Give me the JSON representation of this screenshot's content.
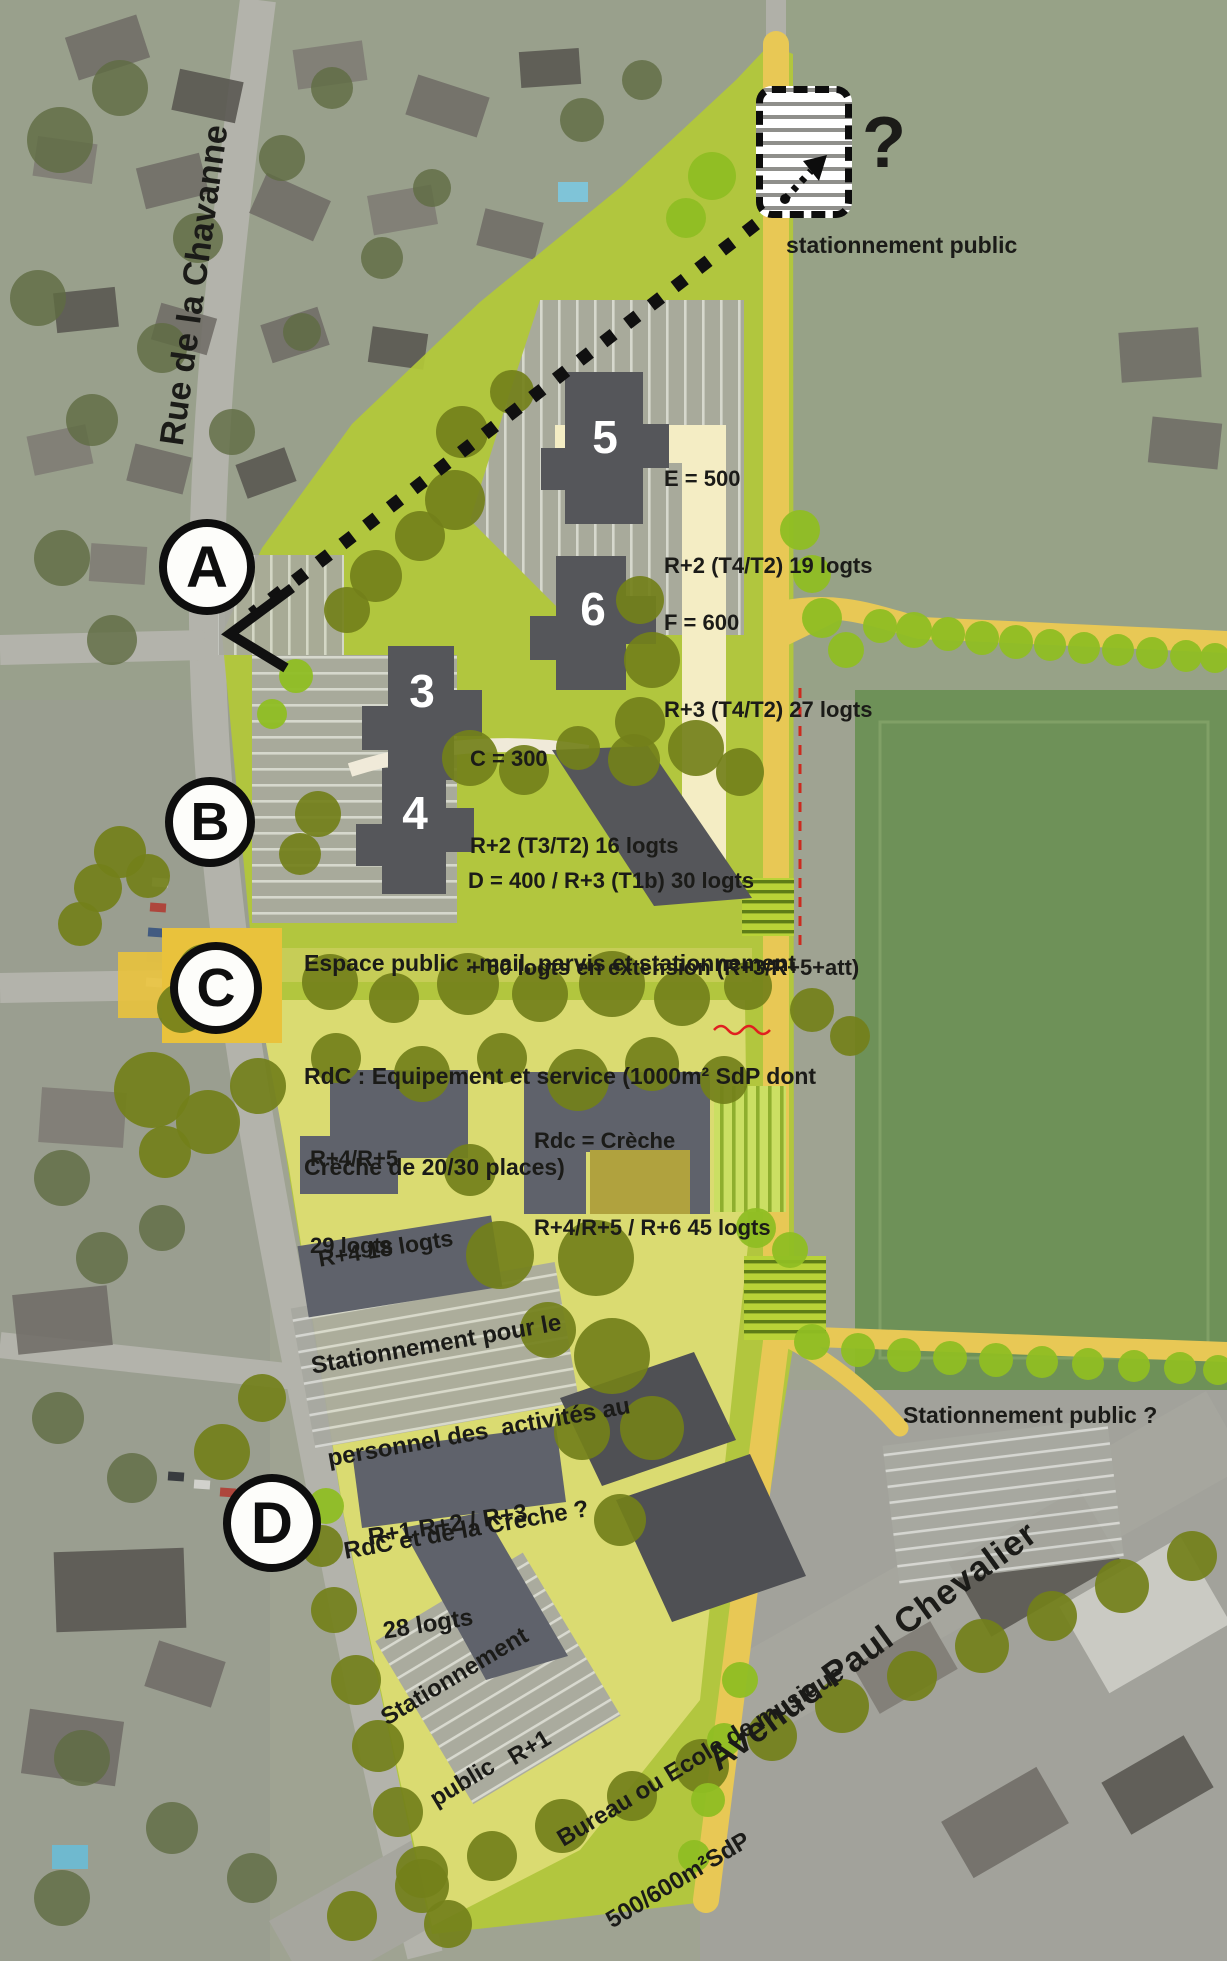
{
  "streets": {
    "chavanne": "Rue de la Chavanne",
    "chevalier": "Avenue Paul Chevalier"
  },
  "markers": {
    "a": "A",
    "b": "B",
    "c": "C",
    "d": "D"
  },
  "top": {
    "question": "?",
    "parking_label": "stationnement public"
  },
  "b5": {
    "num": "5",
    "l1": "E = 500",
    "l2": "R+2 (T4/T2) 19 logts"
  },
  "b6": {
    "num": "6",
    "l1": "F = 600",
    "l2": "R+3 (T4/T2) 27 logts"
  },
  "b3": {
    "num": "3",
    "l1": "C = 300",
    "l2": "R+2 (T3/T2) 16 logts"
  },
  "b4": {
    "num": "4",
    "l1": "D = 400 / R+3 (T1b) 30 logts",
    "l2": "+ 50 logts en extension (R+3/R+5+att)"
  },
  "notes": {
    "espace": "Espace public : mail, parvis et stationnement",
    "rdc1": "RdC : Equipement et service (1000m² SdP dont",
    "rdc2": "Crèche de 20/30 places)",
    "r4r5_1": "R+4/R+5",
    "r4r5_2": "29 logts",
    "creche1": "Rdc = Crèche",
    "creche2": "R+4/R+5 / R+6 45 logts",
    "r4_18": "R+4 18 logts",
    "pers1": "Stationnement pour le",
    "pers2": "personnel des  activités au",
    "pers3": "RdC et de la Crèche ?",
    "pub_right": "Stationnement public ?",
    "r123_1": "R+1 R+2 / R+3",
    "r123_2": "28 logts",
    "pub_bottom1": "Stationnement",
    "pub_bottom2": "public",
    "bureau1": "R+1",
    "bureau2": "Bureau ou Ecole de musique",
    "bureau3": "500/600m²SdP"
  },
  "colors": {
    "site_green": "#b3c937",
    "plaza_yellow_green": "#dcdc74",
    "path_yellow": "#e8c855",
    "accent_square": "#e9c23c",
    "cream_road": "#f4edc4",
    "building_gray": "#55565a",
    "building_gray_light": "#5f626b",
    "tree_olive": "#73801a",
    "tree_bright": "#8fbe23",
    "field_green": "#6e9158"
  }
}
